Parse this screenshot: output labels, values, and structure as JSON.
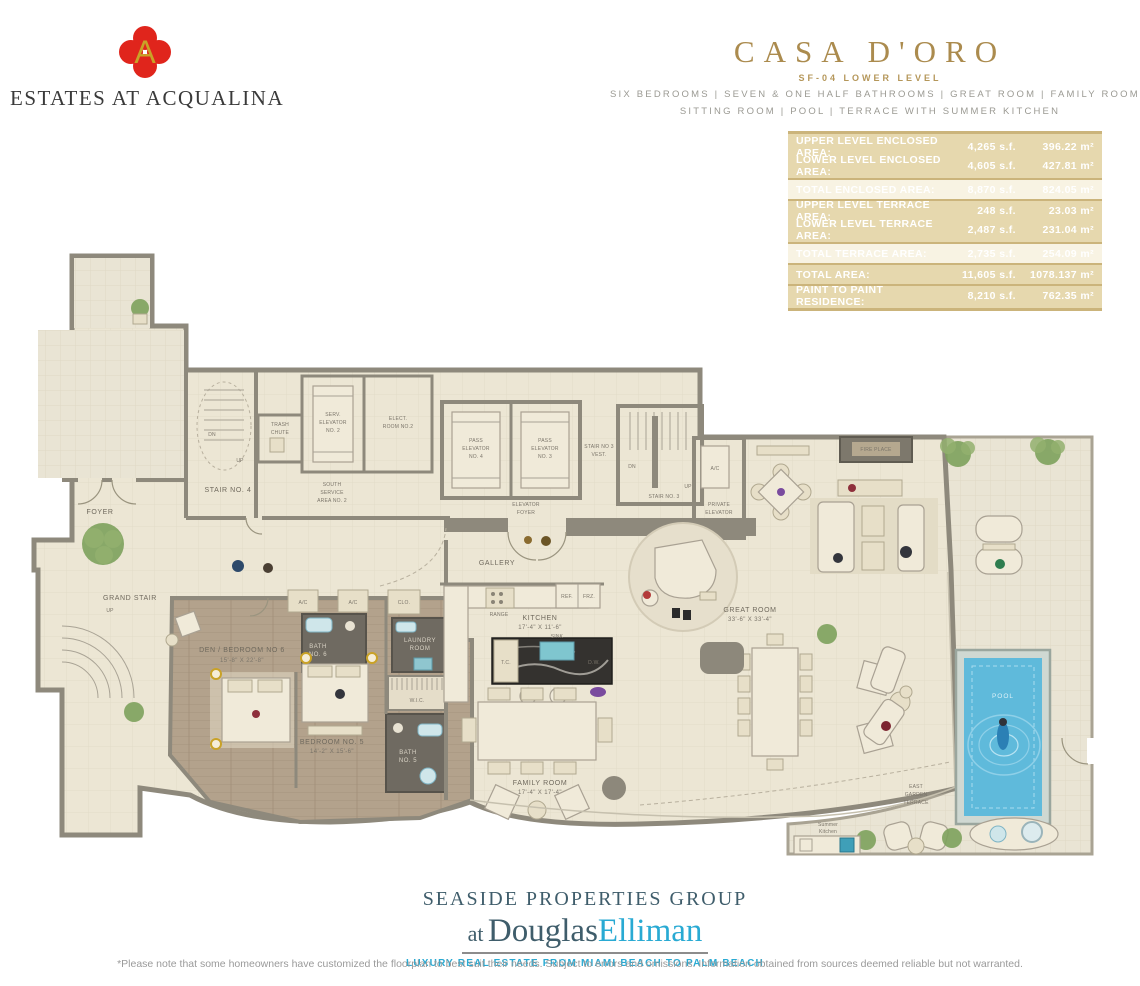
{
  "header": {
    "brand_name": "ESTATES AT ACQUALINA",
    "monogram_letter": "A",
    "title": "CASA D'ORO",
    "subtitle": "SF-04 LOWER LEVEL",
    "features_line1": "SIX BEDROOMS | SEVEN & ONE HALF BATHROOMS | GREAT ROOM | FAMILY ROOM",
    "features_line2": "SITTING ROOM | POOL | TERRACE WITH SUMMER KITCHEN"
  },
  "colors": {
    "gold_accent": "#b5975a",
    "table_bg": "#e6d8ae",
    "table_total_bg": "#f8f3e3",
    "logo_red": "#e0251c",
    "logo_gold": "#c9a227",
    "elliman_blue": "#29aad3",
    "footer_slate": "#3f5d6b",
    "pool_blue": "#5fbadb"
  },
  "area_table": {
    "rows": [
      {
        "label": "UPPER LEVEL ENCLOSED AREA:",
        "sf": "4,265 s.f.",
        "sqm": "396.22 m²"
      },
      {
        "label": "LOWER LEVEL ENCLOSED AREA:",
        "sf": "4,605 s.f.",
        "sqm": "427.81 m²"
      },
      {
        "label": "TOTAL ENCLOSED AREA:",
        "sf": "8,870 s.f.",
        "sqm": "824.05 m²"
      },
      {
        "label": "UPPER LEVEL TERRACE AREA:",
        "sf": "248 s.f.",
        "sqm": "23.03 m²"
      },
      {
        "label": "LOWER LEVEL TERRACE AREA:",
        "sf": "2,487 s.f.",
        "sqm": "231.04 m²"
      },
      {
        "label": "TOTAL TERRACE AREA:",
        "sf": "2,735 s.f.",
        "sqm": "254.09 m²"
      },
      {
        "label": "TOTAL AREA:",
        "sf": "11,605 s.f.",
        "sqm": "1078.137 m²"
      },
      {
        "label": "PAINT TO PAINT RESIDENCE:",
        "sf": "8,210 s.f.",
        "sqm": "762.35 m²"
      }
    ]
  },
  "floorplan": {
    "labels": {
      "foyer": "FOYER",
      "grand_stair": "GRAND STAIR",
      "gallery": "GALLERY",
      "stair4": "STAIR NO. 4",
      "trash": [
        "TRASH",
        "CHUTE"
      ],
      "serv_elev": [
        "SERV.",
        "ELEVATOR",
        "NO. 2"
      ],
      "elect": [
        "ELECT.",
        "ROOM NO.2"
      ],
      "south_service": [
        "SOUTH",
        "SERVICE",
        "AREA NO. 2"
      ],
      "pass4": [
        "PASS",
        "ELEVATOR",
        "NO. 4"
      ],
      "pass3": [
        "PASS",
        "ELEVATOR",
        "NO. 3"
      ],
      "stair3_vest": [
        "STAIR NO 3",
        "VEST."
      ],
      "stair3": "STAIR NO. 3",
      "elev_foyer": [
        "ELEVATOR",
        "FOYER"
      ],
      "ac": "A/C",
      "private_elev": [
        "PRIVATE",
        "ELEVATOR"
      ],
      "den6": [
        "DEN / BEDROOM NO 6",
        "15'-8\" X 22'-8\""
      ],
      "bath6": [
        "BATH",
        "NO. 6"
      ],
      "clo": "CLO.",
      "laundry": [
        "LAUNDRY",
        "ROOM"
      ],
      "wic": "W.I.C.",
      "bed5": [
        "BEDROOM NO. 5",
        "14'-2\" X 15'-6\""
      ],
      "bath5": [
        "BATH",
        "NO. 5"
      ],
      "kitchen": [
        "KITCHEN",
        "17'-4\" X 11'-6\""
      ],
      "range": "RANGE",
      "ref": "REF.",
      "frz": "FRZ.",
      "sink": "SINK",
      "tc": "T.C.",
      "dw": "D.W.",
      "family": [
        "FAMILY ROOM",
        "17'-4\" X 17'-4\""
      ],
      "great": [
        "GREAT ROOM",
        "33'-6\" X 33'-4\""
      ],
      "fireplace": "FIRE PLACE",
      "pool": "POOL",
      "east_terrace": [
        "EAST",
        "GARDEN",
        "TERRACE"
      ],
      "summer": [
        "Summer",
        "Kitchen"
      ],
      "up": "UP",
      "dn": "DN"
    }
  },
  "footer": {
    "brand": "SEASIDE PROPERTIES GROUP",
    "at": "at",
    "douglas": "Douglas",
    "elliman": "Elliman",
    "tagline": "LUXURY REAL ESTATE FROM MIAMI BEACH TO PALM BEACH",
    "disclaimer": "*Please note that some homeowners have customized the floorplan to best suit their needs. Subject to errors and omissions. Information obtained from sources deemed reliable but not warranted."
  }
}
